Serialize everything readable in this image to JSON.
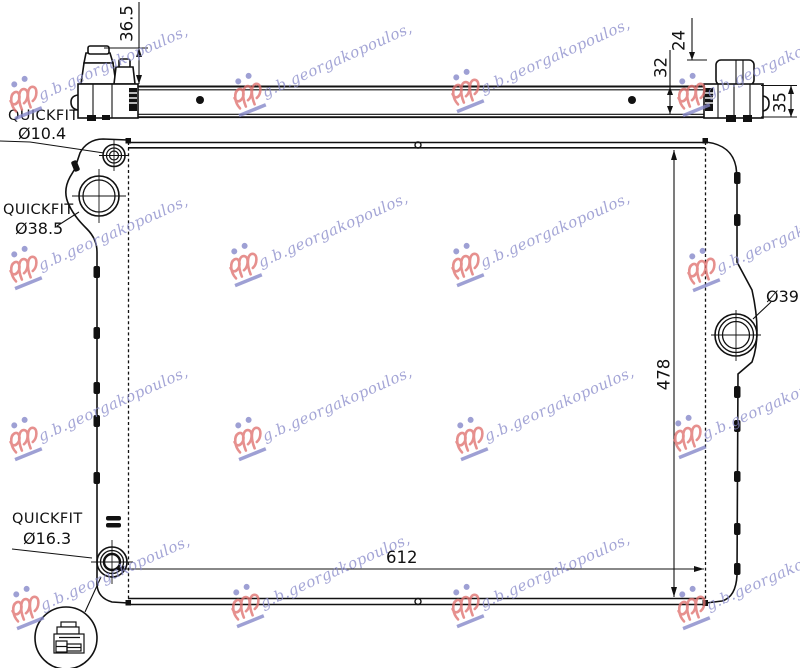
{
  "watermark": {
    "text": "g.b.georgakopoulos,"
  },
  "labels": {
    "port_top": {
      "name": "QUICKFIT",
      "size": "Ø10.4"
    },
    "port_mid": {
      "name": "QUICKFIT",
      "size": "Ø38.5"
    },
    "port_bottom": {
      "name": "QUICKFIT",
      "size": "Ø16.3"
    },
    "port_right": {
      "size": "Ø39"
    }
  },
  "dimensions": {
    "cap_height_left": "36.5",
    "bracket_offset": "24",
    "bar_height": "32",
    "end_fitting_height": "35",
    "core_width": "612",
    "core_height": "478"
  },
  "colors": {
    "line": "#111111",
    "watermark_text": "#8b8dcb",
    "watermark_logo_red": "#e0726f",
    "watermark_logo_blue": "#8486c8"
  }
}
